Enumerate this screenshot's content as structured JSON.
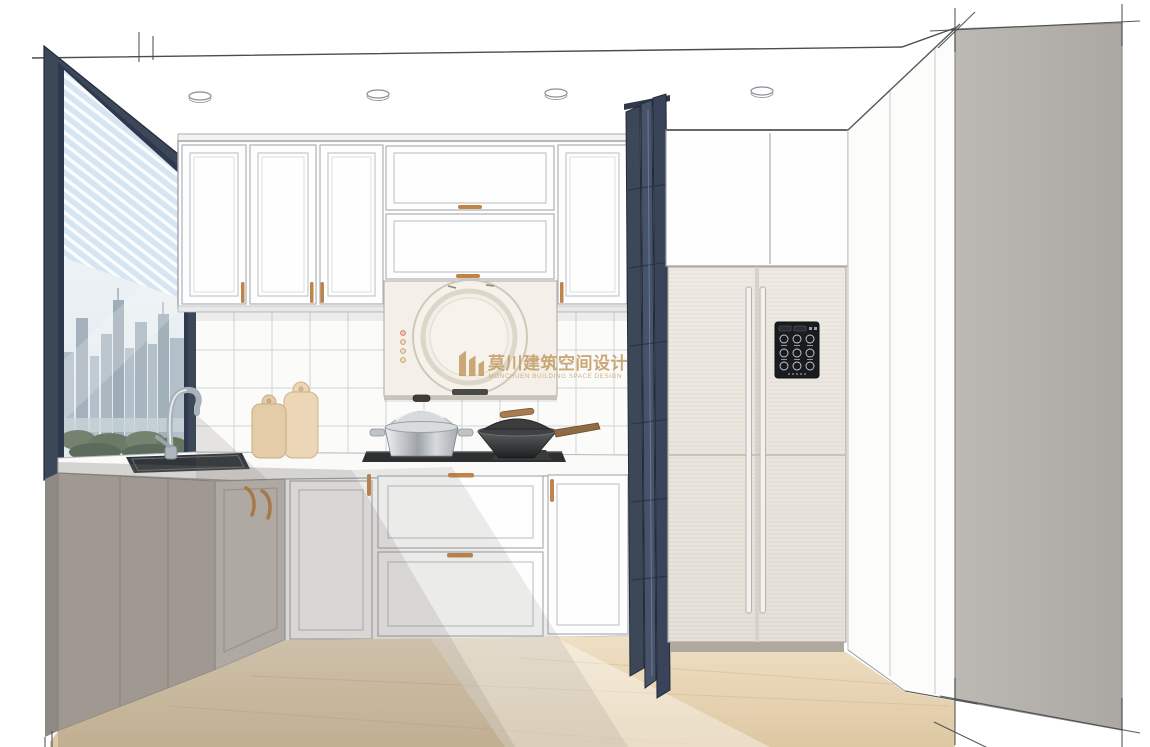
{
  "scene": {
    "kind": "kitchen-interior-design-rendering",
    "style": "sketch-perspective"
  },
  "watermark": {
    "logo_icon": "monchuen-pillars-logo-icon",
    "text_cn": "莫川建筑空间设计",
    "text_en": "MONCHUEN BUILDING SPACE DESIGN",
    "color": "#C49D66"
  },
  "palette": {
    "window_frame_navy": "#3C4758",
    "folding_door_navy": "#3B4556",
    "handle_gold": "#C08448",
    "cabinet_white": "#FDFDFC",
    "shadow_gray": "#6F6962",
    "corner_cabinet_gray": "#B0AAA4",
    "wood_floor": "#E6D2AF",
    "right_wall_gray": "#B4B0AB",
    "blinds_blue": "#D7E5F3",
    "fridge_cream": "#ECE8E0",
    "fridge_screen_dark": "#191C1F",
    "hood_cream": "#F4F0E9"
  },
  "fixtures": {
    "ceiling_lights_count": 4,
    "fridge_screen_dots_count": 5
  }
}
